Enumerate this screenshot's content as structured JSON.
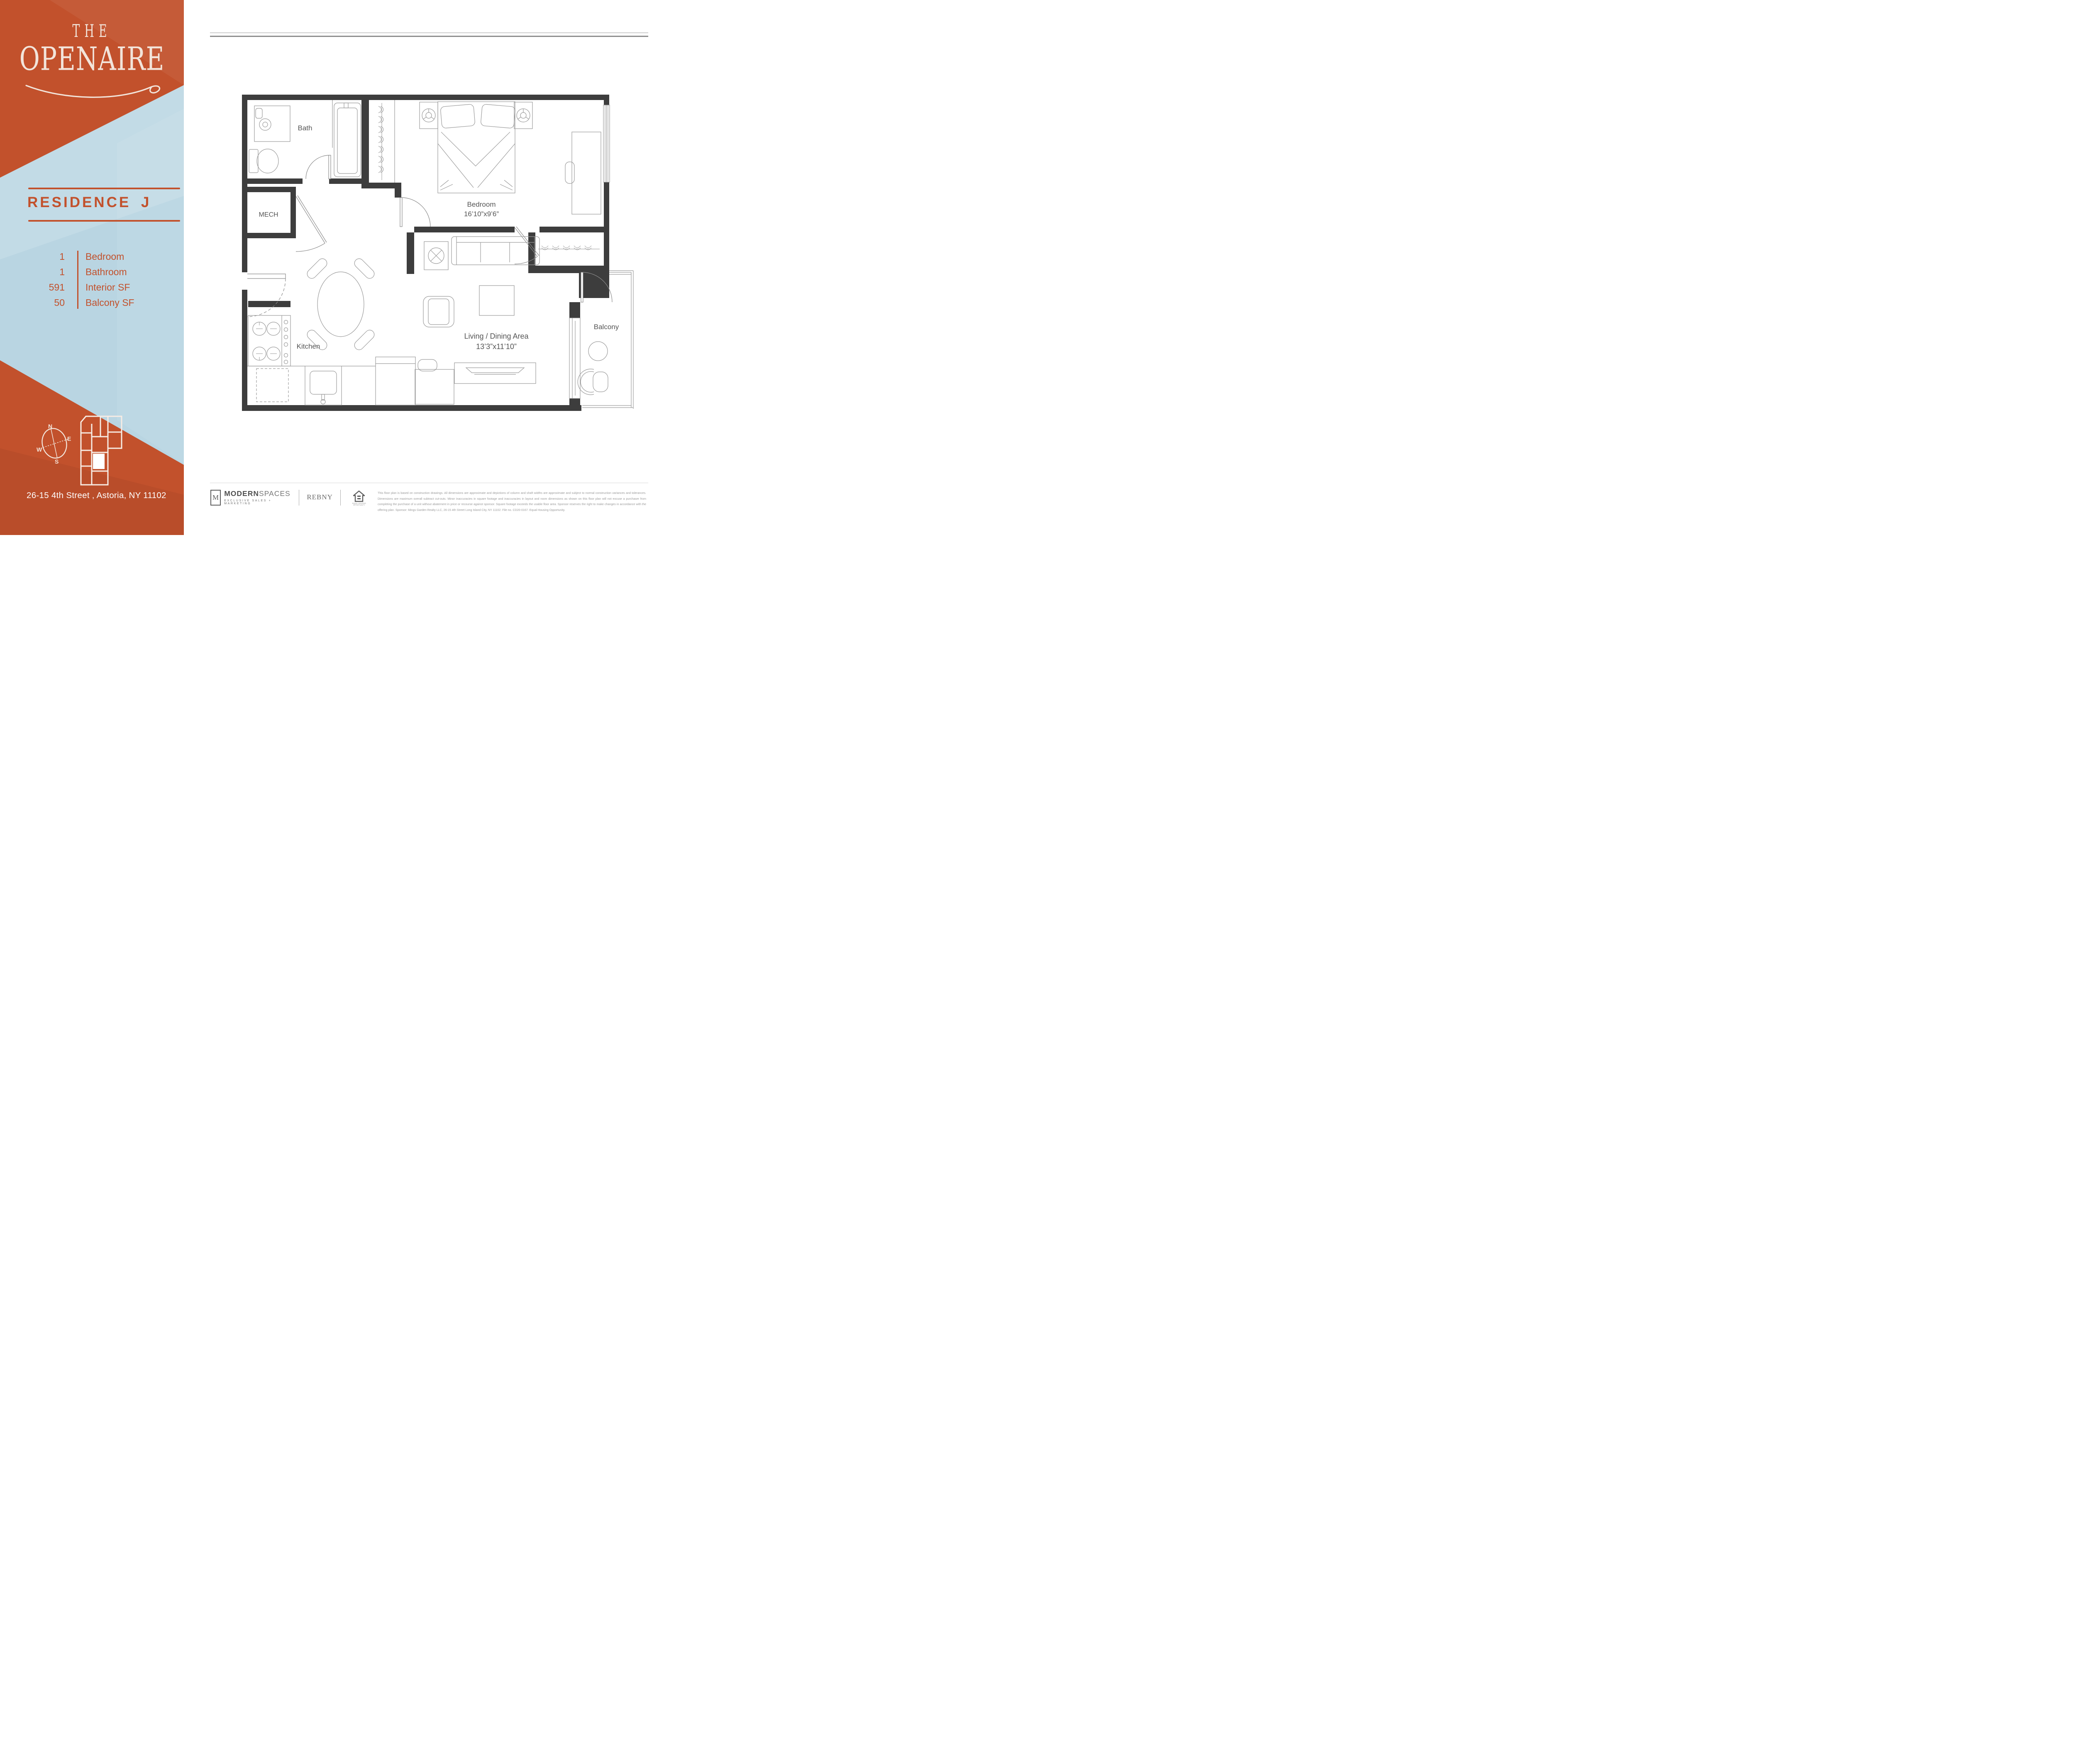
{
  "sidebar": {
    "logo": {
      "line1": "THE",
      "line2": "OPENAIRE"
    },
    "residence_title": "RESIDENCE J",
    "stats": [
      {
        "value": "1",
        "label": "Bedroom"
      },
      {
        "value": "1",
        "label": "Bathroom"
      },
      {
        "value": "591",
        "label": "Interior SF"
      },
      {
        "value": "50",
        "label": "Balcony SF"
      }
    ],
    "compass": {
      "n": "N",
      "e": "E",
      "w": "W",
      "s": "S"
    },
    "address": "26-15 4th Street , Astoria, NY 11102"
  },
  "plan": {
    "labels": {
      "bath": "Bath",
      "mech": "MECH",
      "bedroom": "Bedroom",
      "bedroom_dims": "16’10”x9’6”",
      "kitchen": "Kitchen",
      "living": "Living / Dining Area",
      "living_dims": "13’3”x11’10”",
      "balcony": "Balcony"
    }
  },
  "footer": {
    "modernspaces": {
      "m": "M",
      "name_bold": "MODERN",
      "name_light": "SPACES",
      "tagline": "EXCLUSIVE SALES + MARKETING"
    },
    "rebny": "REBNY",
    "equal_housing_caption": "EQUAL HOUSING OPPORTUNITY",
    "disclaimer": "This floor plan is based on construction drawings. All dimensions are approximate and depictions of column and shaft widths are approximate and subject to normal construction variances and tolerances. Dimensions are maximum overall subtract cut-outs. Minor inaccuracies in square footage and inaccuracies in layout and room dimensions as shown on this floor plan will not excuse a purchaser from completing the purchase of a unit without abatement in price or recourse against sponsor. Square footage exceeds the usable floor area. Sponsor reserves the right to make changes in accordance with the offering plan. Sponsor: Mings Garden Realty LLC, 26-15 4th Street Long Island City, NY 11102. File no. CD20-0167. Equal Housing Opportunity."
  },
  "colors": {
    "orange": "#c2512c",
    "blue": "#b9d5e2",
    "wall": "#3d3d3d",
    "cream": "#f2e4da",
    "furniture_line": "#9a9a9a"
  }
}
